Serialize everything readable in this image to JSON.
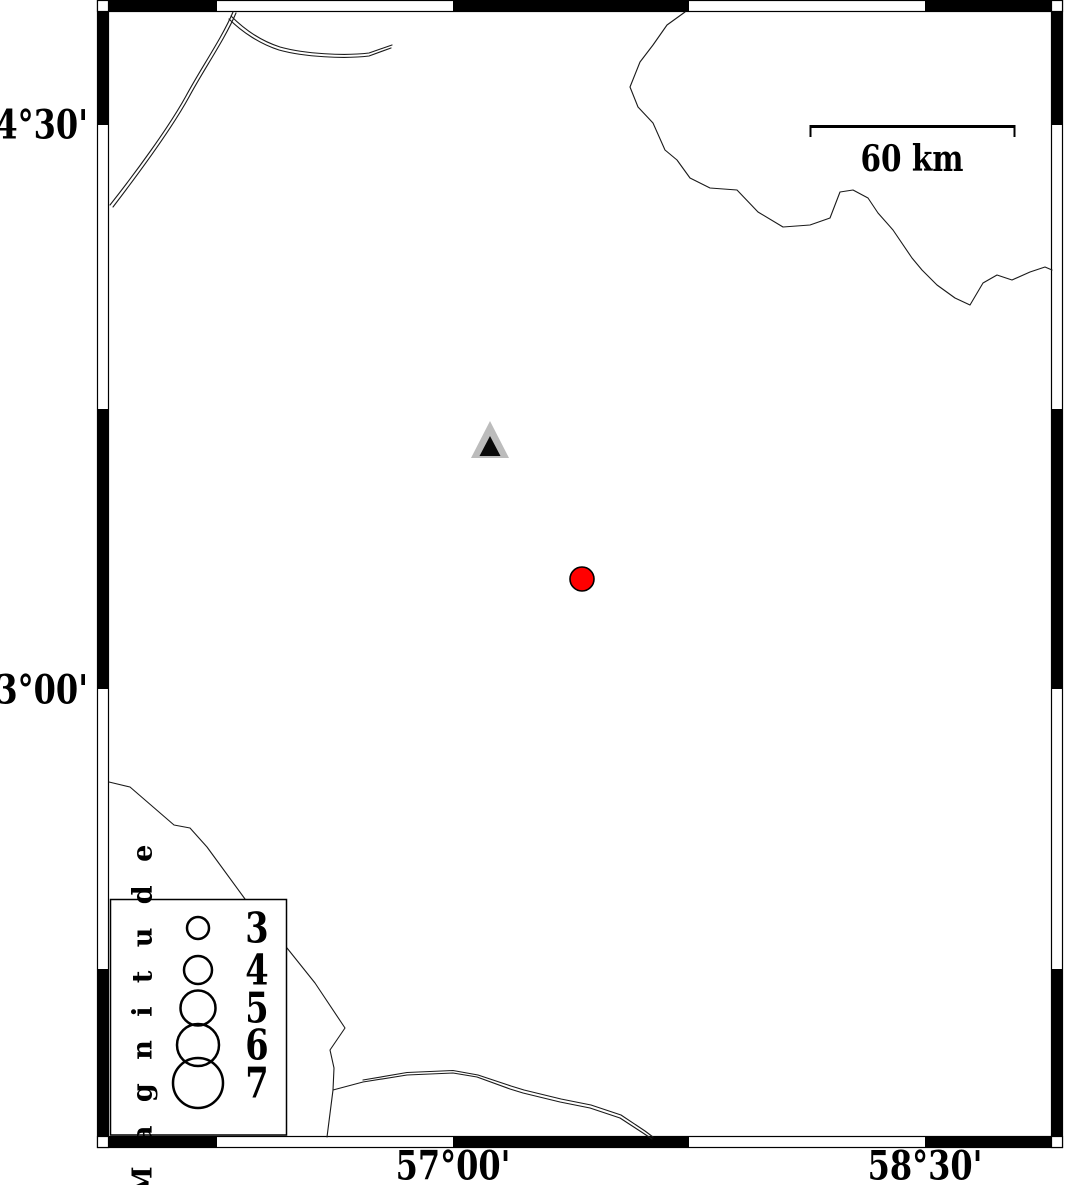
{
  "map": {
    "axis": {
      "lat_labels": [
        {
          "text": "34°30'"
        },
        {
          "text": "33°00'"
        }
      ],
      "lon_labels": [
        {
          "text": "57°00'"
        },
        {
          "text": "58°30'"
        }
      ]
    },
    "scale_bar": {
      "label": "60 km"
    },
    "legend": {
      "title": "M a g n i t u d e",
      "entries": [
        {
          "label": "3"
        },
        {
          "label": "4"
        },
        {
          "label": "5"
        },
        {
          "label": "6"
        },
        {
          "label": "7"
        }
      ]
    },
    "markers": {
      "station": {
        "shape": "triangle",
        "fill": "#bcbcbc",
        "inner_fill": "#0a0a0a"
      },
      "epicenter": {
        "shape": "circle",
        "fill": "#ff0000",
        "stroke": "#000000"
      }
    },
    "colors": {
      "frame": "#000000",
      "coastline": "#1a1a1a",
      "background": "#ffffff"
    }
  }
}
